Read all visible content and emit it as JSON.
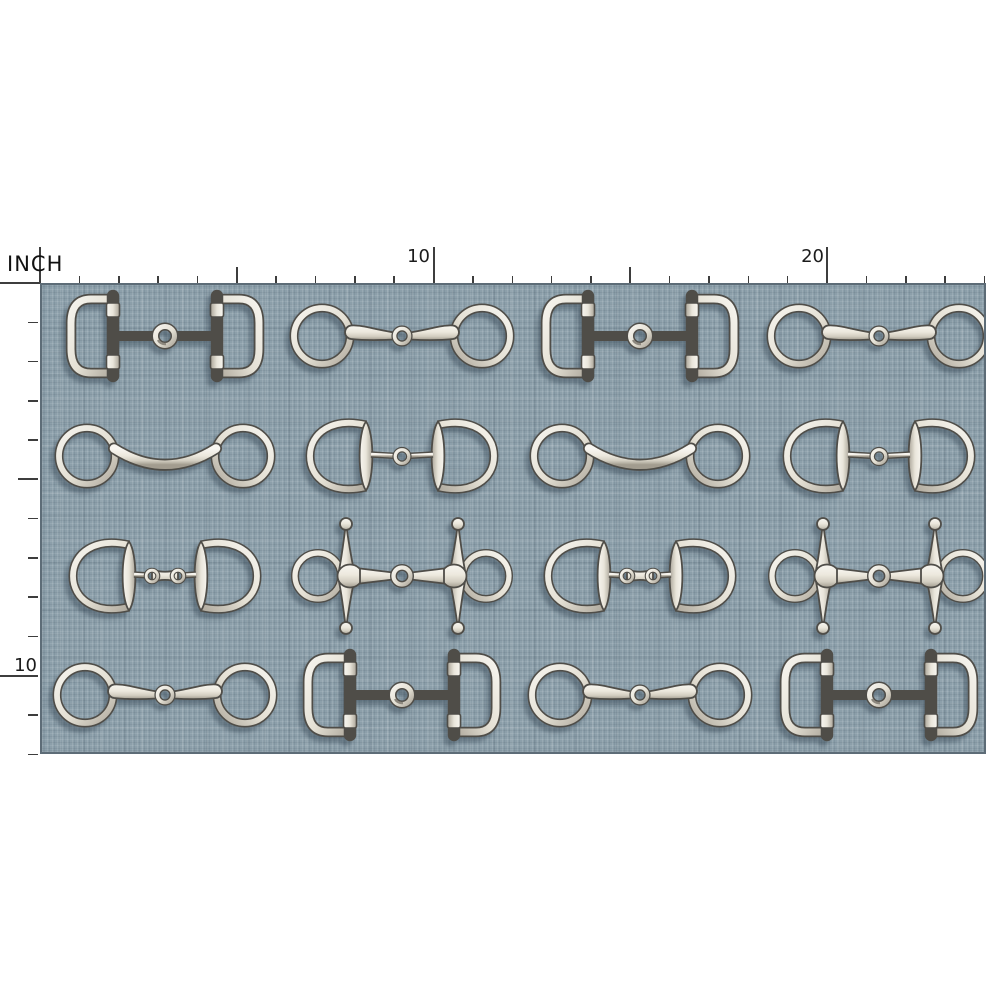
{
  "ruler": {
    "unit_label": "INCH",
    "horizontal": {
      "labels": [
        {
          "value": "10",
          "inch": 10
        },
        {
          "value": "20",
          "inch": 20
        }
      ],
      "total_inches": 24,
      "medium_marks_at": [
        5,
        15
      ]
    },
    "vertical": {
      "labels": [
        {
          "value": "10",
          "inch": 10
        }
      ],
      "total_inches": 12,
      "medium_marks_at": [
        5
      ]
    }
  },
  "swatch": {
    "description": "blue-gray linen texture fabric with horse bit pattern",
    "columns": 4,
    "rows_count": 4
  },
  "bits": {
    "d-ring": {
      "label": "D-ring snaffle bit"
    },
    "loose-ring": {
      "label": "loose ring jointed snaffle bit"
    },
    "mullen-loose-ring": {
      "label": "loose ring mullen mouth bit"
    },
    "eggbutt": {
      "label": "eggbutt jointed snaffle bit"
    },
    "french-link-eggbutt": {
      "label": "eggbutt French link snaffle bit"
    },
    "full-cheek": {
      "label": "full cheek jointed snaffle bit"
    }
  },
  "pattern": {
    "rows": [
      [
        "d-ring",
        "loose-ring",
        "d-ring",
        "loose-ring"
      ],
      [
        "mullen-loose-ring",
        "eggbutt",
        "mullen-loose-ring",
        "eggbutt"
      ],
      [
        "french-link-eggbutt",
        "full-cheek",
        "french-link-eggbutt",
        "full-cheek"
      ],
      [
        "loose-ring",
        "d-ring",
        "loose-ring",
        "d-ring"
      ]
    ]
  },
  "colors": {
    "page_background": "#ffffff",
    "fabric_base": "#8C9FAA",
    "fabric_edge": "#5d6c77",
    "metal_light": "#f8f6f1",
    "metal_mid": "#ece8dd",
    "metal_dark": "#a29c8f",
    "metal_outline": "#4f4d48",
    "ruler_tick": "#3d3d3d",
    "label_text": "#1c1c1c"
  }
}
